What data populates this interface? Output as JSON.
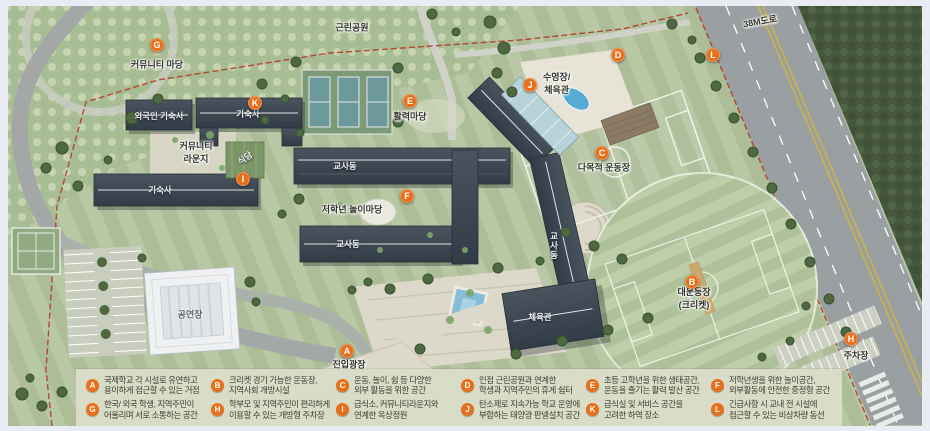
{
  "colors": {
    "marker_orange": "#e8701a",
    "boundary_red": "#b23a27",
    "legend_bg": "#d9dcc7",
    "grass_green": "#b3c49e",
    "forest_green": "#46573d",
    "road_gray": "#9aa0a2",
    "building_slate": "#3d4855",
    "pool_blue": "#55abd1"
  },
  "map": {
    "markers": [
      {
        "letter": "G",
        "x": 157,
        "y": 45
      },
      {
        "letter": "K",
        "x": 255,
        "y": 103
      },
      {
        "letter": "E",
        "x": 410,
        "y": 101
      },
      {
        "letter": "J",
        "x": 530,
        "y": 85
      },
      {
        "letter": "D",
        "x": 618,
        "y": 55
      },
      {
        "letter": "L",
        "x": 713,
        "y": 55
      },
      {
        "letter": "I",
        "x": 243,
        "y": 179
      },
      {
        "letter": "F",
        "x": 407,
        "y": 196
      },
      {
        "letter": "C",
        "x": 602,
        "y": 153
      },
      {
        "letter": "B",
        "x": 692,
        "y": 282
      },
      {
        "letter": "A",
        "x": 347,
        "y": 351
      },
      {
        "letter": "H",
        "x": 851,
        "y": 339
      }
    ],
    "labels": [
      {
        "text": "근린공원",
        "x": 352,
        "y": 27,
        "style": "area"
      },
      {
        "text": "38M도로",
        "x": 760,
        "y": 21,
        "style": "area",
        "rot": -10
      },
      {
        "text": "커뮤니티 마당",
        "x": 157,
        "y": 64,
        "style": "area"
      },
      {
        "text": "활력마당",
        "x": 410,
        "y": 116,
        "style": "area"
      },
      {
        "text": "수영장/|체육관",
        "x": 543,
        "y": 83,
        "style": "area",
        "anchor": "l"
      },
      {
        "text": "다목적 운동장",
        "x": 604,
        "y": 167,
        "style": "area"
      },
      {
        "text": "저학년 놀이마당",
        "x": 352,
        "y": 209,
        "style": "area"
      },
      {
        "text": "대운동장|(크리켓)",
        "x": 694,
        "y": 298,
        "style": "area"
      },
      {
        "text": "주차장",
        "x": 856,
        "y": 355,
        "style": "area"
      },
      {
        "text": "진입광장",
        "x": 349,
        "y": 364,
        "style": "area"
      },
      {
        "text": "커뮤니티|라운지",
        "x": 196,
        "y": 152,
        "style": "area"
      },
      {
        "text": "외국인 기숙사",
        "x": 159,
        "y": 116,
        "style": "bldg"
      },
      {
        "text": "기숙사",
        "x": 248,
        "y": 114,
        "style": "bldg"
      },
      {
        "text": "기숙사",
        "x": 160,
        "y": 190,
        "style": "bldg"
      },
      {
        "text": "식당",
        "x": 245,
        "y": 158,
        "style": "bldg",
        "rot": -35
      },
      {
        "text": "교사동",
        "x": 345,
        "y": 166,
        "style": "bldg"
      },
      {
        "text": "교사동",
        "x": 348,
        "y": 244,
        "style": "bldg"
      },
      {
        "text": "교사동",
        "x": 554,
        "y": 246,
        "style": "bldg",
        "vert": true
      },
      {
        "text": "체육관",
        "x": 540,
        "y": 317,
        "style": "bldg"
      },
      {
        "text": "공연장",
        "x": 190,
        "y": 314,
        "style": "onlight"
      }
    ]
  },
  "legend": {
    "items": [
      {
        "letter": "A",
        "line1": "국제학교 각 시설로 유연하고",
        "line2": "용이하게 접근할 수 있는 거점"
      },
      {
        "letter": "B",
        "line1": "크리켓 경기 가능한 운동장,",
        "line2": "지역사회 개방시설"
      },
      {
        "letter": "C",
        "line1": "운동, 놀이, 쉼 등 다양한",
        "line2": "외부 활동을 위한 공간"
      },
      {
        "letter": "D",
        "line1": "인접 근린공원과 연계한",
        "line2": "학생과 지역주민의 휴게 쉼터"
      },
      {
        "letter": "E",
        "line1": "초등 고학년을 위한 생태공간,",
        "line2": "운동을 즐기는 활력 발산 공간"
      },
      {
        "letter": "F",
        "line1": "저학년생을 위한 놀이공간,",
        "line2": "외부활동에 안전한 중정형 공간"
      },
      {
        "letter": "G",
        "line1": "한국/ 외국 학생, 지역주민이",
        "line2": "어울리며 서로 소통하는 공간"
      },
      {
        "letter": "H",
        "line1": "학부모 및 지역주민이 편리하게",
        "line2": "이용할 수 있는 개방형 주차장"
      },
      {
        "letter": "I",
        "line1": "급식소, 커뮤니티라운지와",
        "line2": "연계한 옥상정원"
      },
      {
        "letter": "J",
        "line1": "탄소제로 지속가능 학교 운영에",
        "line2": "부합하는 태양광 판넬설치 공간"
      },
      {
        "letter": "K",
        "line1": "급식실 및 서비스 공간을",
        "line2": "고려한 하역 장소"
      },
      {
        "letter": "L",
        "line1": "긴급사항 시 교내 전 시설에",
        "line2": "접근할 수 있는 비상차량 동선"
      }
    ]
  }
}
